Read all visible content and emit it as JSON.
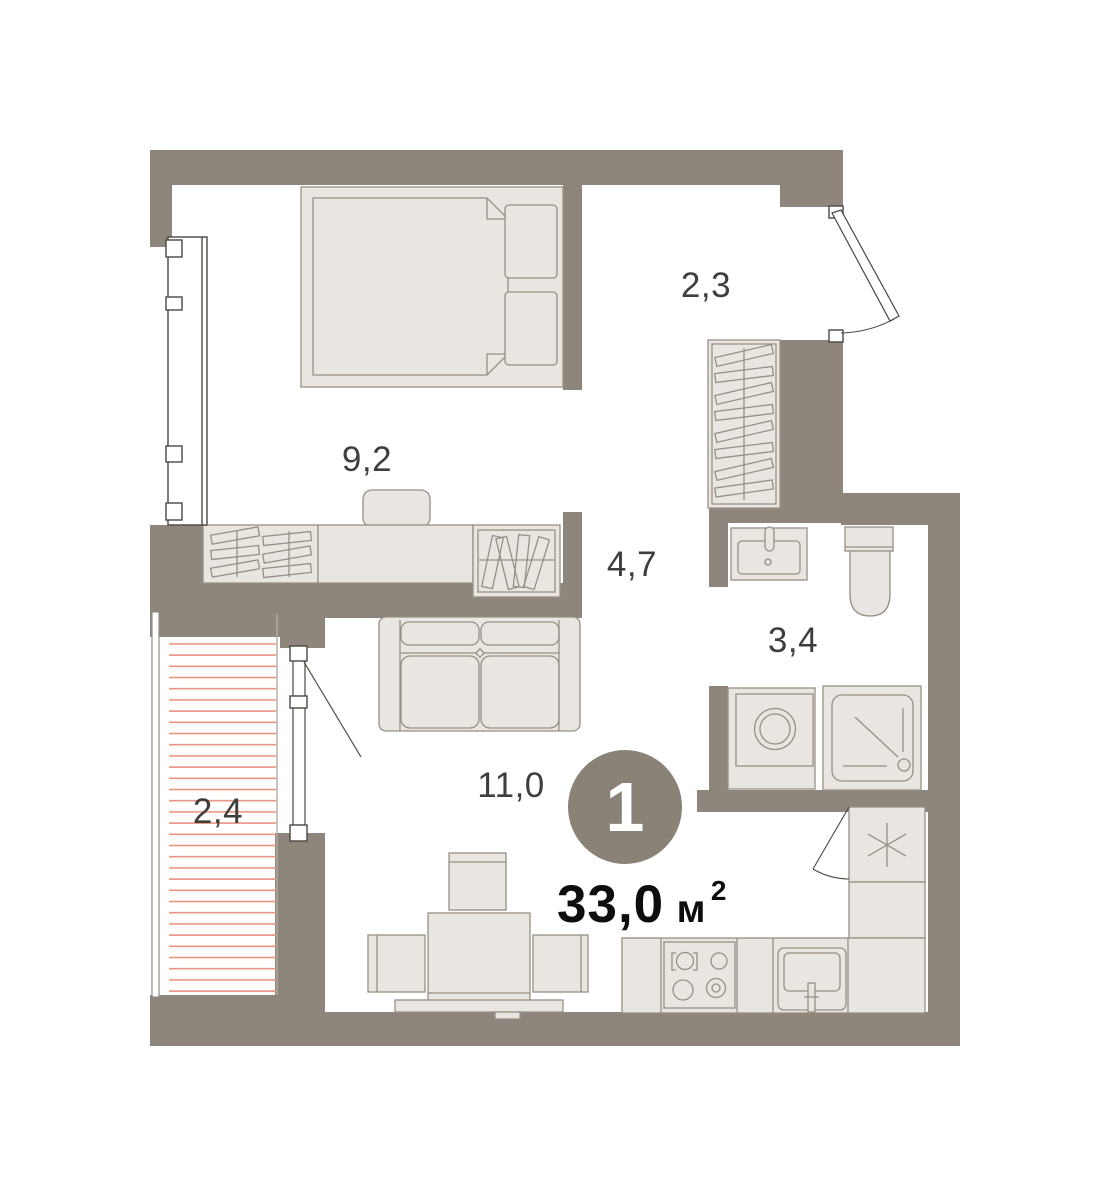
{
  "plan": {
    "unit": {
      "number": "1",
      "area_value": "33,0",
      "area_unit": "м",
      "area_sup": "2"
    },
    "rooms": [
      {
        "id": "bedroom",
        "area_label": "9,2"
      },
      {
        "id": "entry-hall",
        "area_label": "2,3"
      },
      {
        "id": "hallway",
        "area_label": "4,7"
      },
      {
        "id": "bathroom",
        "area_label": "3,4"
      },
      {
        "id": "balcony",
        "area_label": "2,4"
      },
      {
        "id": "kitchen-living-room",
        "area_label": "11,0"
      }
    ],
    "colors": {
      "wall": "#8e867c",
      "furniture_fill": "#e9e6e1",
      "furniture_stroke": "#978f84",
      "window_stroke": "#4b4741",
      "light_divider": "#b3aba1",
      "balcony_hatch": "#e6937f",
      "label_text": "#3f3e3b",
      "unit_badge": "#8a8177",
      "unit_number_text": "#ffffff",
      "area_text": "#0d0d0d"
    }
  }
}
